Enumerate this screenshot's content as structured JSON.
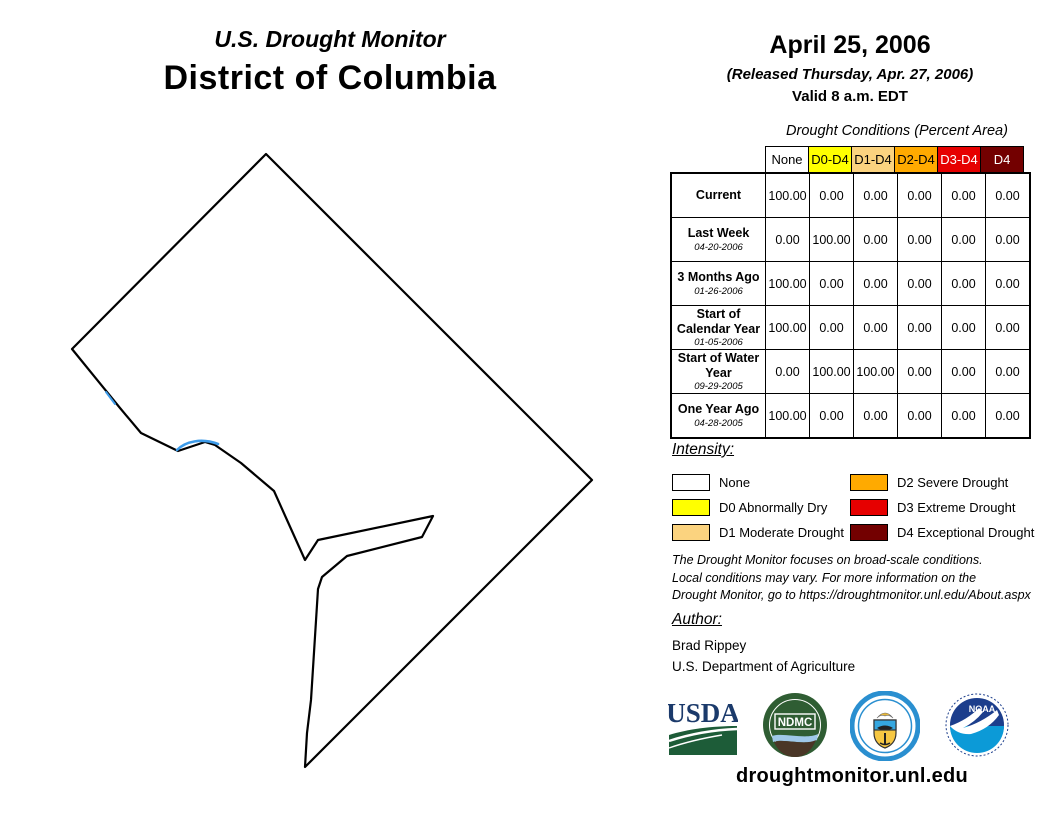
{
  "header": {
    "report_title": "U.S. Drought Monitor",
    "region": "District of Columbia"
  },
  "date_block": {
    "date": "April 25, 2006",
    "released": "(Released Thursday, Apr. 27, 2006)",
    "valid": "Valid 8 a.m. EDT"
  },
  "colors": {
    "none": "#FFFFFF",
    "d0": "#FFFF00",
    "d1": "#FBD37F",
    "d2": "#FFAA00",
    "d3": "#E60000",
    "d4": "#730000",
    "map_outline": "#000000",
    "river": "#3D9BE9"
  },
  "table": {
    "title": "Drought Conditions (Percent Area)",
    "columns": [
      "None",
      "D0-D4",
      "D1-D4",
      "D2-D4",
      "D3-D4",
      "D4"
    ],
    "rows": [
      {
        "label": "Current",
        "date": "",
        "values": [
          "100.00",
          "0.00",
          "0.00",
          "0.00",
          "0.00",
          "0.00"
        ]
      },
      {
        "label": "Last Week",
        "date": "04-20-2006",
        "values": [
          "0.00",
          "100.00",
          "0.00",
          "0.00",
          "0.00",
          "0.00"
        ]
      },
      {
        "label": "3 Months Ago",
        "date": "01-26-2006",
        "values": [
          "100.00",
          "0.00",
          "0.00",
          "0.00",
          "0.00",
          "0.00"
        ]
      },
      {
        "label": "Start of Calendar Year",
        "date": "01-05-2006",
        "values": [
          "100.00",
          "0.00",
          "0.00",
          "0.00",
          "0.00",
          "0.00"
        ]
      },
      {
        "label": "Start of Water Year",
        "date": "09-29-2005",
        "values": [
          "0.00",
          "100.00",
          "100.00",
          "0.00",
          "0.00",
          "0.00"
        ]
      },
      {
        "label": "One Year Ago",
        "date": "04-28-2005",
        "values": [
          "100.00",
          "0.00",
          "0.00",
          "0.00",
          "0.00",
          "0.00"
        ]
      }
    ]
  },
  "legend": {
    "heading": "Intensity:",
    "items": [
      {
        "label": "None",
        "color": "#FFFFFF"
      },
      {
        "label": "D0 Abnormally Dry",
        "color": "#FFFF00"
      },
      {
        "label": "D1 Moderate Drought",
        "color": "#FBD37F"
      },
      {
        "label": "D2 Severe Drought",
        "color": "#FFAA00"
      },
      {
        "label": "D3 Extreme Drought",
        "color": "#E60000"
      },
      {
        "label": "D4 Exceptional Drought",
        "color": "#730000"
      }
    ]
  },
  "disclaimer": {
    "line1": "The Drought Monitor focuses on broad-scale conditions.",
    "line2": "Local conditions may vary. For more information on the",
    "line3": "Drought Monitor, go to https://droughtmonitor.unl.edu/About.aspx"
  },
  "author": {
    "heading": "Author:",
    "name": "Brad Rippey",
    "org": "U.S. Department of Agriculture"
  },
  "footer": {
    "url": "droughtmonitor.unl.edu",
    "logo_texts": {
      "usda": "USDA",
      "ndmc": "NDMC",
      "noaa": "NOAA"
    }
  }
}
